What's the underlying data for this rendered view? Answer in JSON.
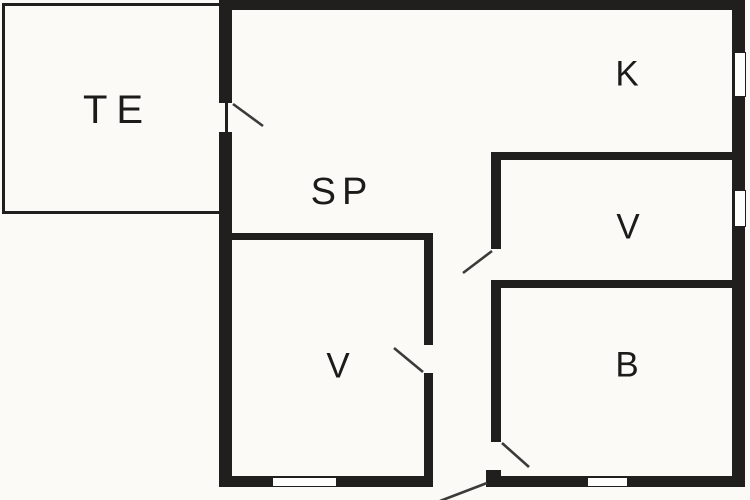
{
  "plan_title": "floor-plan",
  "rooms": [
    {
      "id": "te",
      "label": "TE"
    },
    {
      "id": "k",
      "label": "K"
    },
    {
      "id": "sp",
      "label": "SP"
    },
    {
      "id": "v-right",
      "label": "V"
    },
    {
      "id": "v-bottom",
      "label": "V"
    },
    {
      "id": "b",
      "label": "B"
    }
  ],
  "colors": {
    "background": "#fbfaf6",
    "wall": "#201f1d",
    "door_line": "#3b3b39",
    "window_fill": "#fefefc",
    "label": "#1b1b19"
  }
}
